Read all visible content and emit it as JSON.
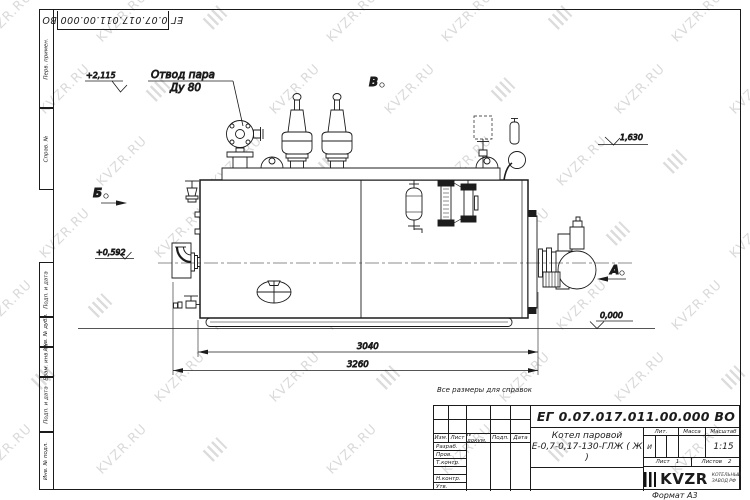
{
  "watermark": {
    "text": "KVZR.RU",
    "color": "#dadada"
  },
  "frame": {
    "top_doc_number": "ЕГ 0.07.017.011.00.000  ВО",
    "side_columns": [
      "Перв. примен.",
      "Справ. №",
      "Подп. и дата",
      "Инв. № дубл.",
      "Взам. инв. №",
      "Подп. и дата",
      "Инв. № подл."
    ]
  },
  "drawing": {
    "callout": {
      "line1": "Отвод пара",
      "line2": "Ду 80"
    },
    "elevations": {
      "valves_top": "+2,115",
      "gauge_level": "1,630",
      "inlet_level": "+0,592",
      "ground": "0,000"
    },
    "views": {
      "front": "А",
      "left": "Б",
      "top": "В"
    },
    "dims": {
      "inner": "3040",
      "outer": "3260"
    }
  },
  "note": "Все размеры для справок",
  "title_block": {
    "doc_number": "ЕГ 0.07.017.011.00.000  ВО",
    "product_line1": "Котел паровой",
    "product_line2": "Е-0,7-0,17-130-ГЛЖ ( Ж )",
    "header_cols": [
      "Изм.",
      "Лист",
      "N докум.",
      "Подп.",
      "Дата"
    ],
    "sign_rows": [
      "Разраб.",
      "Пров.",
      "Т.контр.",
      "Н.контр.",
      "Утв."
    ],
    "lit_header": "Лит.",
    "mass_header": "Масса",
    "scale_header": "Масштаб",
    "lit_value": "И",
    "scale_value": "1:15",
    "sheet_label": "Лист",
    "sheet_value": "1",
    "sheets_label": "Листов",
    "sheets_value": "2",
    "logo_word": "KVZR",
    "logo_sub1": "КОТЕЛЬНЫЙ",
    "logo_sub2": "ЗАВОД РФ",
    "format_label": "Формат А3"
  }
}
